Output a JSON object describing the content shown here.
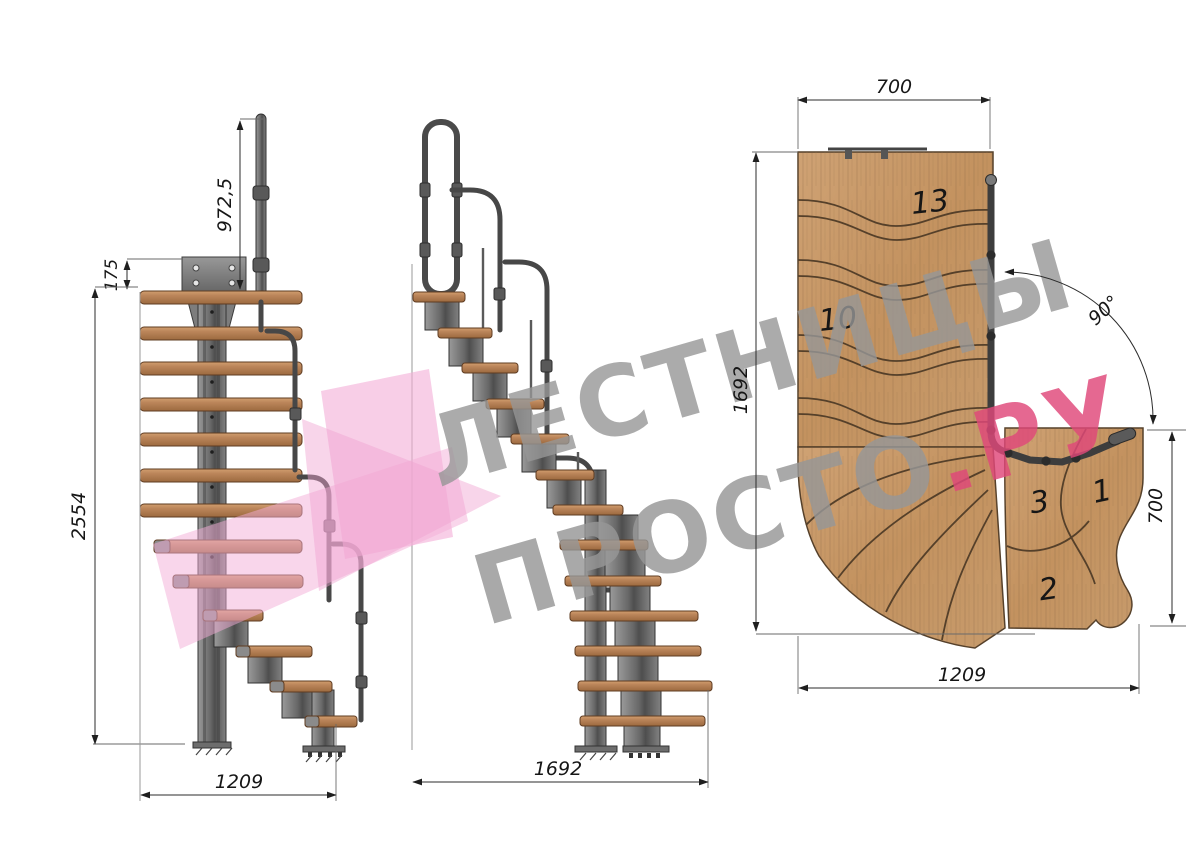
{
  "watermark": {
    "line1": "ЛЕСТНИЦЫ",
    "line2": "ПРОСТО",
    "line2_accent": ".РУ",
    "gray_color": "#979797",
    "accent_color": "#e0487a",
    "logo_pink": "#f3aed7"
  },
  "front_view": {
    "dim_handrail_height": "972,5",
    "dim_top_offset": "175",
    "dim_total_height": "2554",
    "dim_width": "1209"
  },
  "side_view": {
    "dim_length": "1692"
  },
  "plan_view": {
    "dim_top_width": "700",
    "dim_left_length": "1692",
    "dim_bottom_width": "1209",
    "dim_right_width": "700",
    "dim_angle": "90°",
    "steps": {
      "s13": "13",
      "s10": "10",
      "s3": "3",
      "s1": "1",
      "s2": "2"
    }
  },
  "colors": {
    "wood": "#c59a6d",
    "metal": "#6e6e6e"
  }
}
